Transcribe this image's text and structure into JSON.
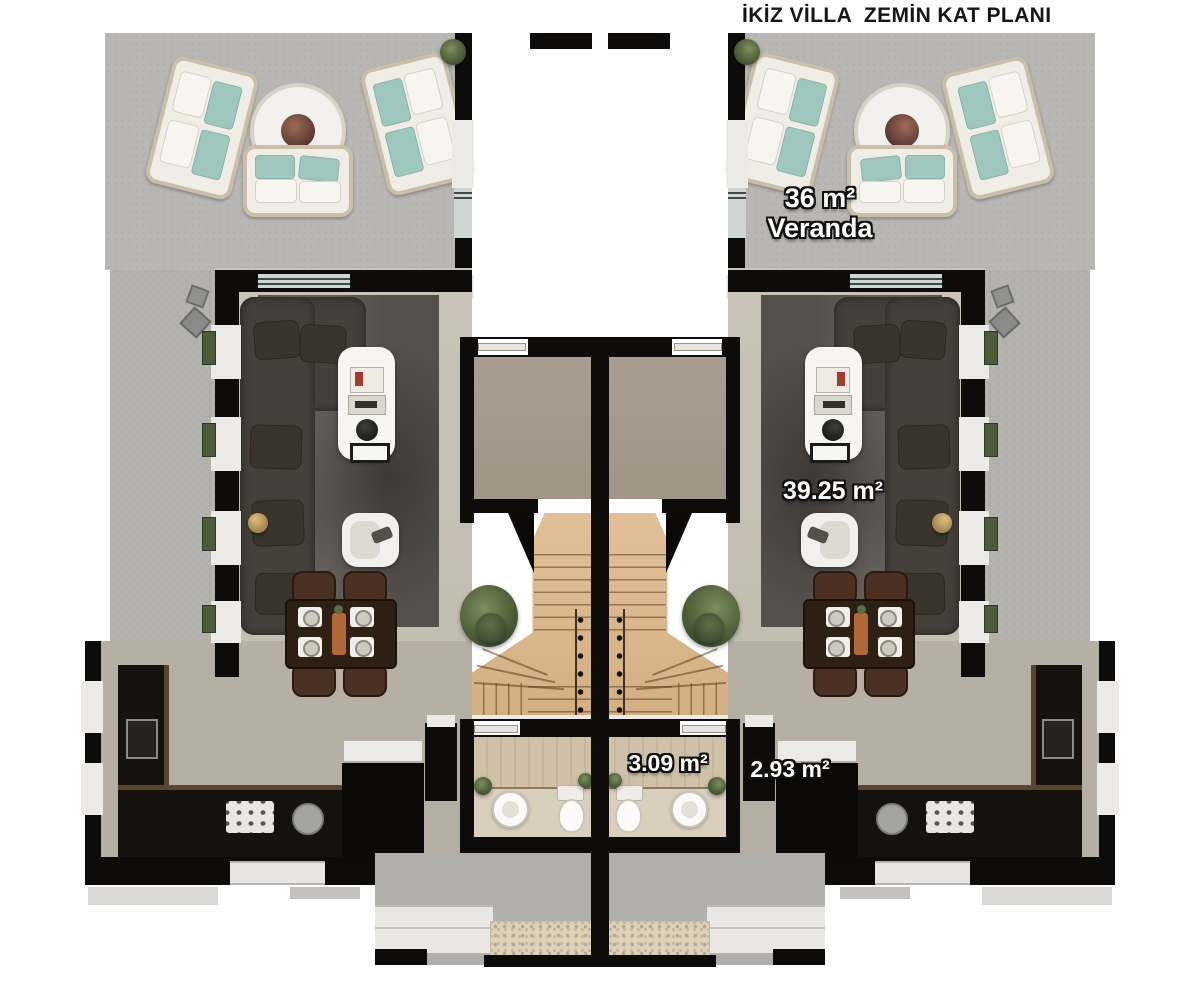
{
  "title": "İKİZ VİLLA  ZEMİN KAT PLANI",
  "labels": {
    "veranda_area": "36 m²",
    "veranda_name": "Veranda",
    "living_area": "39.25 m²",
    "wc_area": "3.09 m²",
    "hall_area": "2.93 m²"
  },
  "colors": {
    "background": "#ffffff",
    "wall_black": "#0e0c0a",
    "veranda_floor": "#b9b7b4",
    "living_floor": "#c9c2b7",
    "kitchen_floor": "#b6afa4",
    "entry_floor": "#a69b8d",
    "bath_floor": "#dacfbd",
    "rug_dark": "#56504a",
    "stair_wood": "#dcba92",
    "sofa_dark": "#46403a",
    "outdoor_sofa_white": "#f0ede7",
    "cushion_teal": "#9ec7bd",
    "dining_wood": "#2f2016",
    "plant_green": "#4a5a36",
    "label_text": "#ffffff"
  }
}
